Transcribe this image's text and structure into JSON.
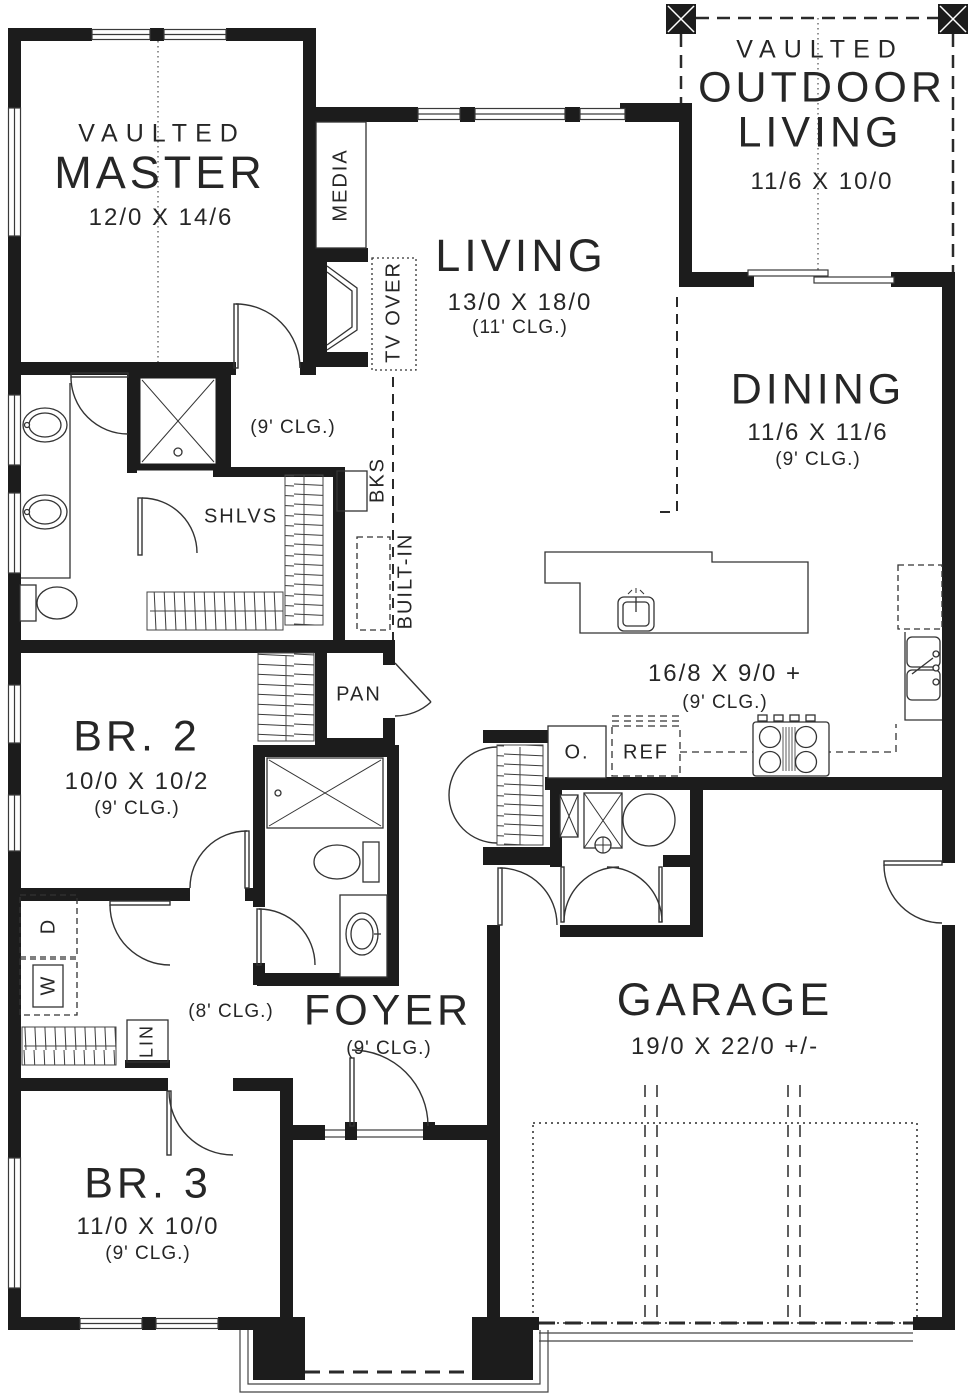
{
  "plan_title": "floor-plan",
  "rooms": {
    "master": {
      "tag": "VAULTED",
      "name": "MASTER",
      "dims": "12/0 X 14/6"
    },
    "living": {
      "name": "LIVING",
      "dims": "13/0 X 18/0",
      "clg": "(11' CLG.)"
    },
    "outdoor_living": {
      "tag": "VAULTED",
      "line1": "OUTDOOR",
      "line2": "LIVING",
      "dims": "11/6 X 10/0"
    },
    "dining": {
      "name": "DINING",
      "dims": "11/6 X 11/6",
      "clg": "(9' CLG.)"
    },
    "kitchen": {
      "dims": "16/8 X 9/0 +",
      "clg": "(9' CLG.)"
    },
    "bedroom2": {
      "name": "BR. 2",
      "dims": "10/0 X 10/2",
      "clg": "(9' CLG.)"
    },
    "bedroom3": {
      "name": "BR. 3",
      "dims": "11/0 X 10/0",
      "clg": "(9' CLG.)"
    },
    "foyer": {
      "name": "FOYER",
      "clg": "(9' CLG.)"
    },
    "garage": {
      "name": "GARAGE",
      "dims": "19/0 X 22/0 +/-"
    },
    "master_hall": {
      "clg": "(9' CLG.)"
    },
    "bed_hall": {
      "clg": "(8' CLG.)"
    }
  },
  "features": {
    "media": "MEDIA",
    "tv_over": "TV OVER",
    "bks": "BKS",
    "built_in": "BUILT-IN",
    "shlvs": "SHLVS",
    "pan": "PAN",
    "oven": "O.",
    "fridge": "REF",
    "linen": "LIN",
    "washer": "W",
    "dryer": "D"
  },
  "colors": {
    "wall": "#1c1c1c",
    "line": "#2a2a2a",
    "bg": "#ffffff"
  }
}
